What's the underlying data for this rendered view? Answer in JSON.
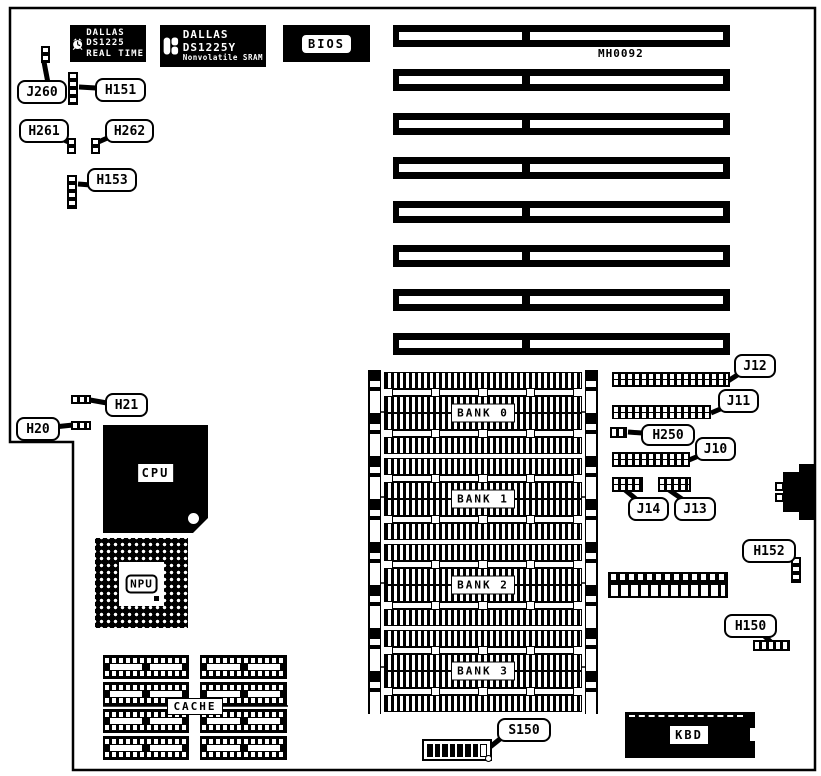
{
  "board": {
    "part_number": "MH0092",
    "type": "motherboard-layout-diagram"
  },
  "chips": {
    "rtc": {
      "brand": "DALLAS",
      "part": "DS1225",
      "subtitle": "REAL TIME"
    },
    "nvram": {
      "brand": "DALLAS",
      "part": "DS1225Y",
      "subtitle": "Nonvolatile SRAM"
    },
    "bios": {
      "label": "BIOS"
    },
    "cpu": {
      "label": "CPU"
    },
    "npu": {
      "label": "NPU"
    },
    "cache": {
      "label": "CACHE",
      "chip_count": 8
    },
    "kbd": {
      "label": "KBD"
    }
  },
  "memory": {
    "sockets_per_bank": 4,
    "banks": [
      {
        "label": "BANK 0"
      },
      {
        "label": "BANK 1"
      },
      {
        "label": "BANK 2"
      },
      {
        "label": "BANK 3"
      }
    ]
  },
  "expansion": {
    "isa_slot_count": 8
  },
  "switches": {
    "s150_positions": 8
  },
  "callouts": {
    "j260": "J260",
    "h151": "H151",
    "h261": "H261",
    "h262": "H262",
    "h153": "H153",
    "h21": "H21",
    "h20": "H20",
    "j12": "J12",
    "j11": "J11",
    "h250": "H250",
    "j10": "J10",
    "j14": "J14",
    "j13": "J13",
    "h152": "H152",
    "h150": "H150",
    "s150": "S150"
  },
  "colors": {
    "foreground": "#000000",
    "background": "#ffffff"
  }
}
